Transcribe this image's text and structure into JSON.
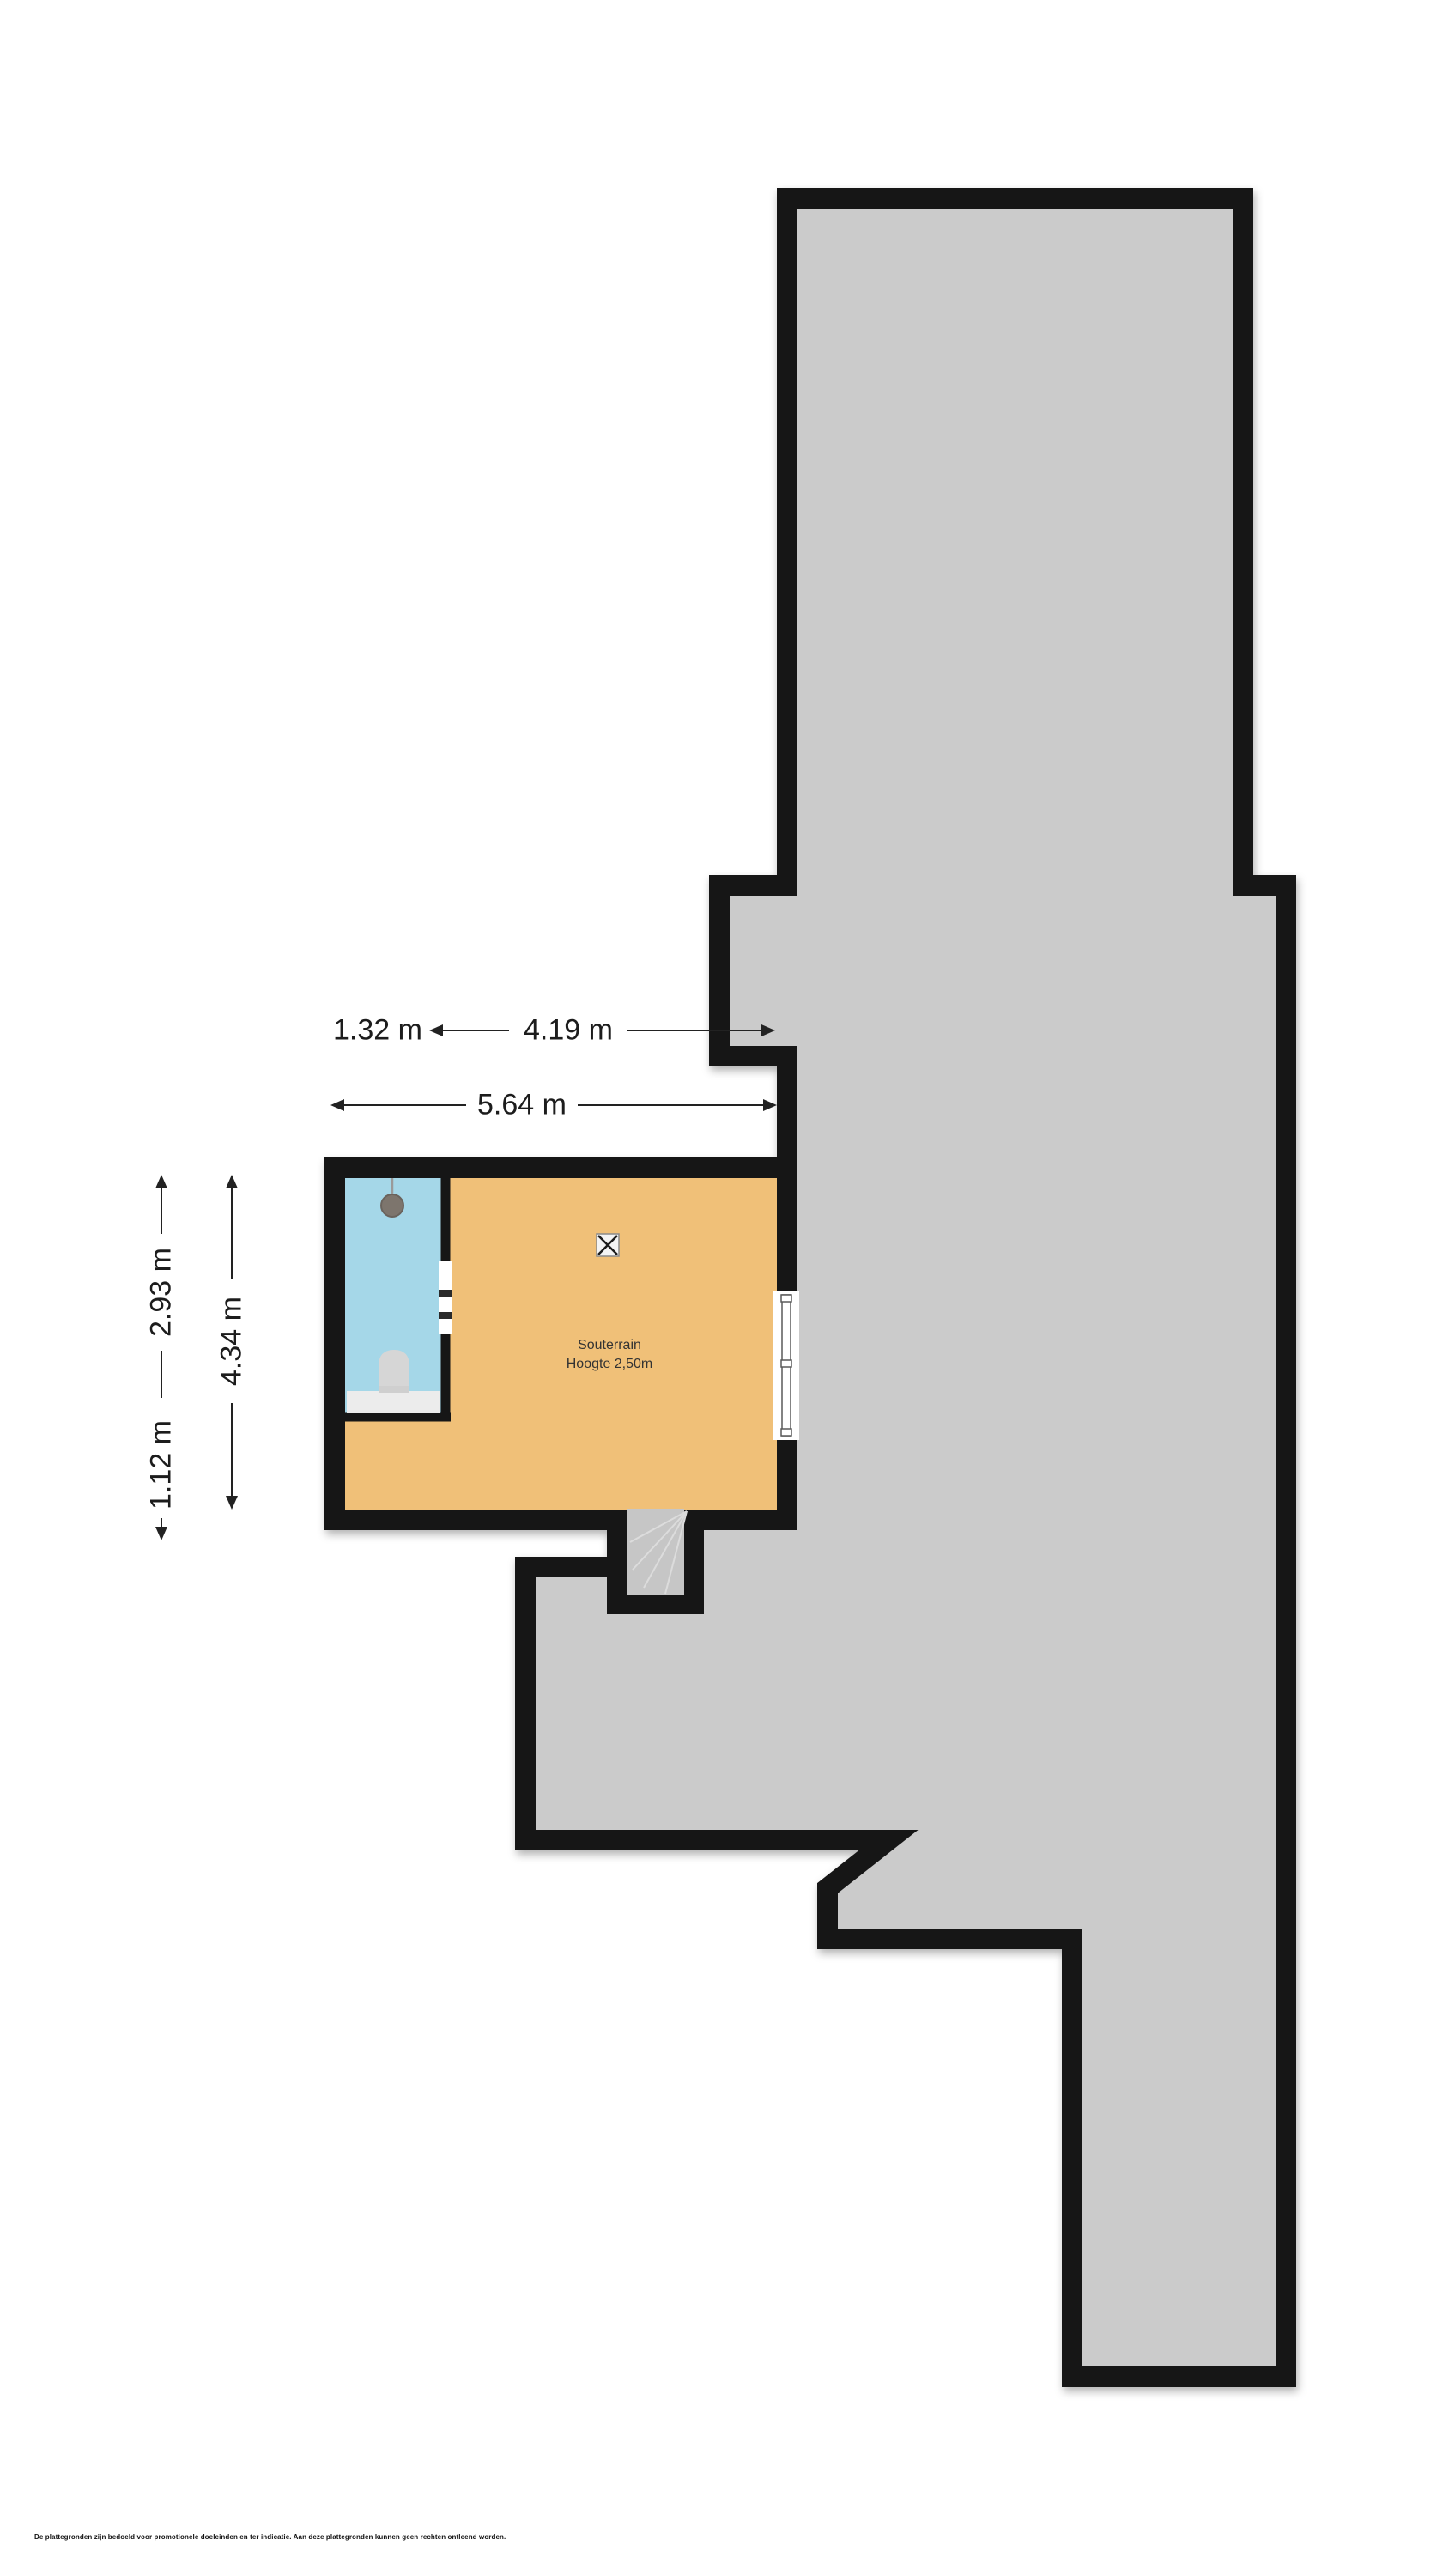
{
  "floorplan": {
    "rooms": {
      "souterrain": {
        "name": "Souterrain",
        "height_note": "Hoogte 2,50m"
      }
    },
    "dimensions": {
      "top_offset": "1.32 m",
      "top_inner_width": "4.19 m",
      "total_width": "5.64 m",
      "left_upper": "2.93 m",
      "left_lower": "1.12 m",
      "left_total": "4.34 m"
    },
    "disclaimer": "De plattegronden zijn bedoeld voor promotionele doeleinden en ter indicatie. Aan deze plattegronden kunnen geen rechten ontleend worden.",
    "colors": {
      "wall": "#161616",
      "floor_gray": "#cbcbcb",
      "floor_orange": "#f0c078",
      "floor_blue": "#a5d7e8",
      "stair": "#c6c6c6"
    }
  }
}
